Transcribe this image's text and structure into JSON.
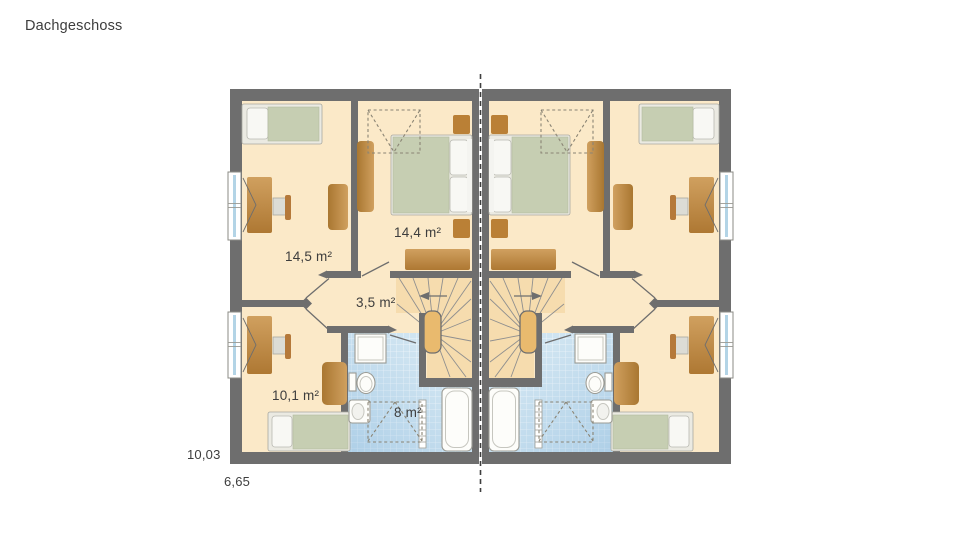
{
  "page_title": "Dachgeschoss",
  "plan": {
    "type": "floor-plan",
    "building": "semi-detached house, attic storey, two mirrored units",
    "room_labels": {
      "bedroom_top": "14,5 m²",
      "bedroom_center": "14,4 m²",
      "hallway": "3,5 m²",
      "bedroom_bottom": "10,1 m²",
      "bathroom": "8 m²"
    },
    "outer_dimensions": {
      "width_m": "10,03",
      "depth_m": "6,65"
    },
    "symbols": [
      "single-bed",
      "double-bed",
      "pillow",
      "desk",
      "chair",
      "wardrobe",
      "dresser",
      "nightstand",
      "sideboard",
      "winder-stairs",
      "stair-handrail",
      "direction-arrow",
      "shower",
      "toilet",
      "washbasin",
      "bathtub",
      "towel-radiator",
      "roof-window-dashed",
      "door-swing",
      "casement-window",
      "party-wall-dashed-line"
    ],
    "colors": {
      "wall": "#6e6e6e",
      "room_floor": "#fbe9c8",
      "stair_floor": "#f6dcae",
      "bath_tile": "#cfe4f1",
      "furniture_wood": "#c08a48",
      "mattress_green": "#c6ceb2",
      "fixture_white": "#fdfdfa",
      "text": "#3d3d3d"
    }
  }
}
